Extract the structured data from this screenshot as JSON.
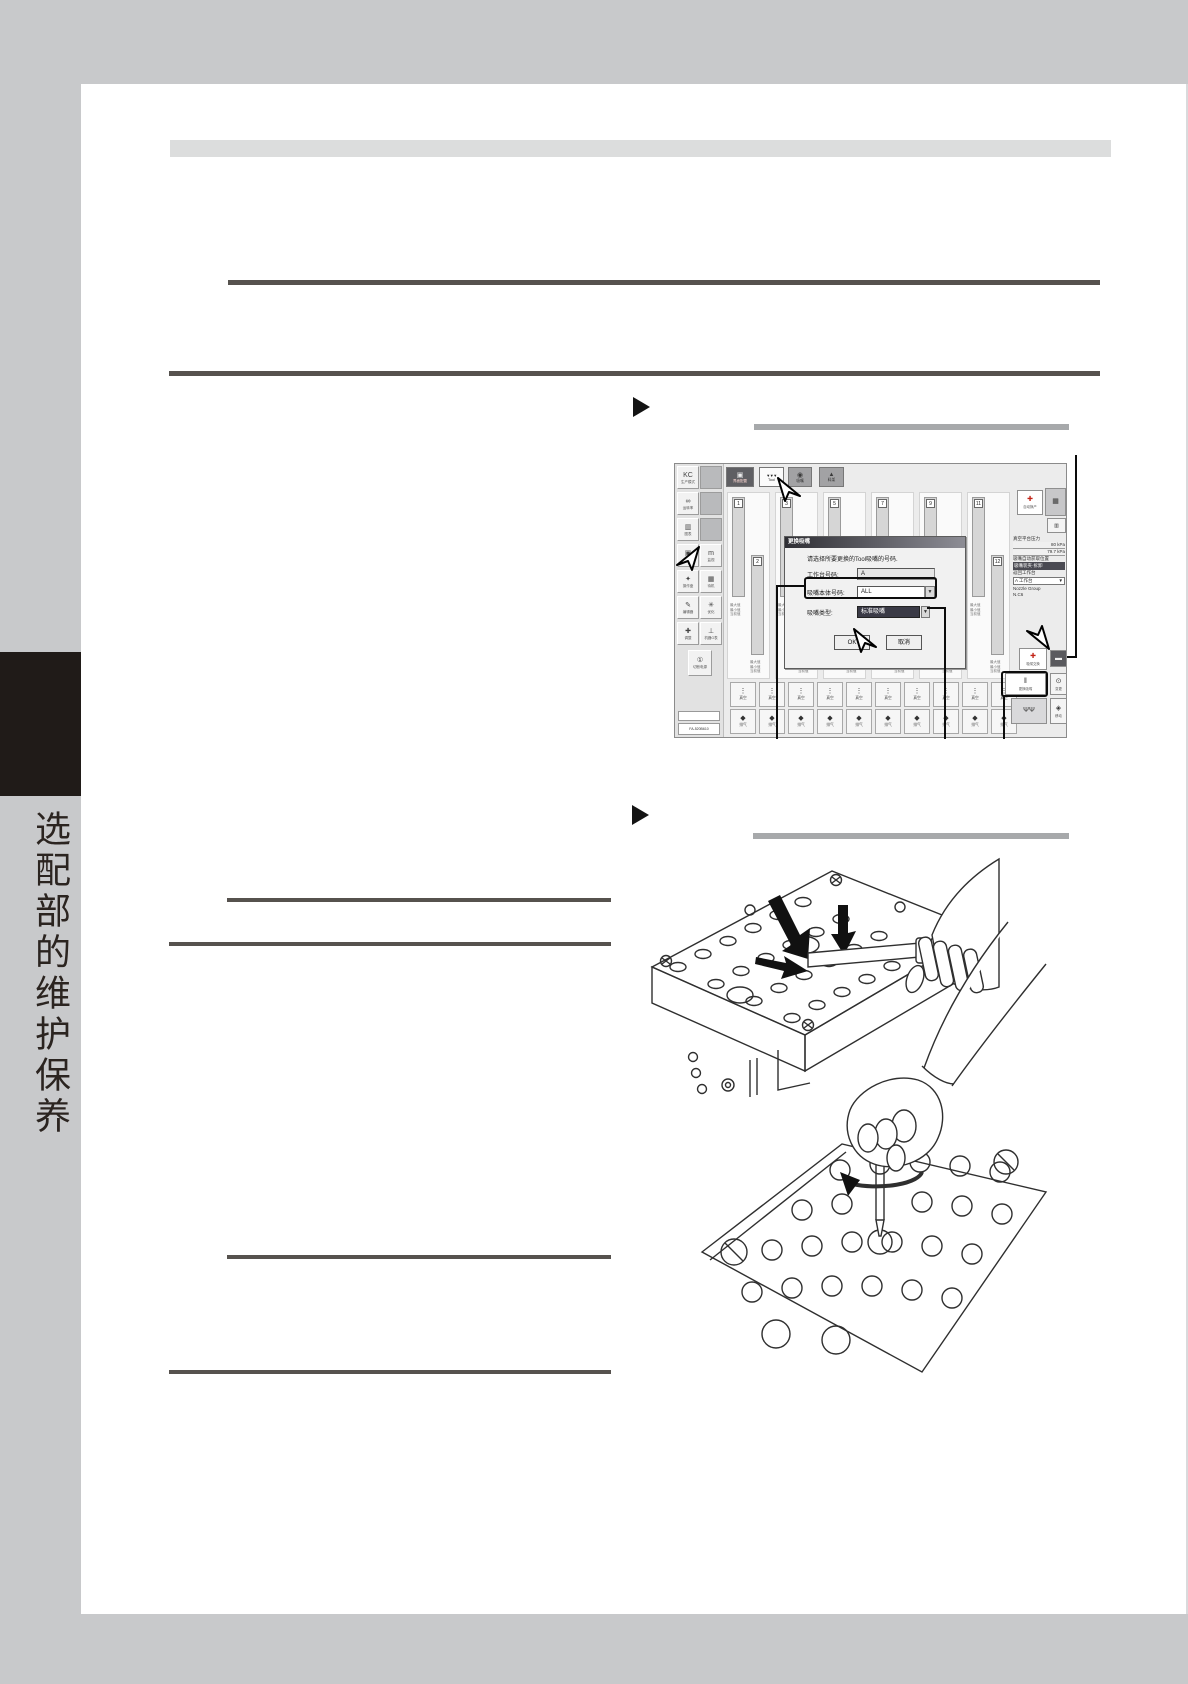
{
  "colors": {
    "canvas": "#c8c9cb",
    "rule": "#56524e",
    "section_bar": "#a7a9ab",
    "tab": "#201b18",
    "header_band": "#dcdddd"
  },
  "sidebar": {
    "tab_label": "选配部的维护保养"
  },
  "screenshot": {
    "top_toolbar": [
      {
        "glyph": "▣",
        "label": "界面配置"
      },
      {
        "glyph": "▼▼▼",
        "label": "Tool"
      },
      {
        "glyph": "◉",
        "label": "吸嘴"
      },
      {
        "glyph": "▲",
        "label": "料架"
      }
    ],
    "left_col1": [
      {
        "g": "ΚϹ",
        "label": "生产模式"
      },
      {
        "g": "∞",
        "label": "运转率"
      },
      {
        "g": "▥",
        "label": "图表"
      },
      {
        "g": "▣",
        "label": "屏幕"
      },
      {
        "g": "✦",
        "label": "操作盘"
      },
      {
        "g": "✎",
        "label": "编辑器"
      },
      {
        "g": "✚",
        "label": "调整"
      }
    ],
    "left_col2": [
      {
        "g": "m",
        "label": "监视"
      },
      {
        "g": "▦",
        "label": "待机"
      },
      {
        "g": "✳",
        "label": "优化"
      },
      {
        "g": "⊥",
        "label": "机器G表"
      }
    ],
    "power": {
      "g": "①",
      "label": "切断电源"
    },
    "status": {
      "line1": "",
      "line2": "FA-520B610"
    },
    "lanes": {
      "list": [
        {
          "back": "1",
          "front": "2"
        },
        {
          "back": "3",
          "front": "4"
        },
        {
          "back": "5",
          "front": "6"
        },
        {
          "back": "7",
          "front": "8"
        },
        {
          "back": "9",
          "front": "10"
        },
        {
          "back": "11",
          "front": "12"
        }
      ],
      "info": [
        "最大值",
        "最小值",
        "当前值"
      ]
    },
    "dialog": {
      "title": "更换吸嘴",
      "message": "请选择所要更换的Tool吸嘴的号码.",
      "field1_label": "工作台号码:",
      "field1_value": "A",
      "field2_label": "吸嘴本体号码:",
      "field2_value": "ALL",
      "field3_label": "吸嘴类型:",
      "field3_value": "标准吸嘴",
      "ok_label": "OK",
      "cancel_label": "取消"
    },
    "right_panel": {
      "btn_auto": {
        "g": "✚",
        "label": "自动换产"
      },
      "btn_cam": {
        "g": "▦",
        "label": ""
      },
      "btn_sub": {
        "g": "▥",
        "label": ""
      },
      "info_title": "真空平台压力",
      "info_value1": "80 kPa",
      "info_value2": "79.7 kPa",
      "info_label2": "吸嘴自动获取位置",
      "info_highlight": "吸嘴装夹·拆卸",
      "combo_label": "返回工作台",
      "combo_value": "A 工作台",
      "combo_arrow": "▼",
      "group_label": "Nozzle Group",
      "group_value": "N.C6",
      "grid": [
        {
          "g": "✚",
          "label": "吸嘴交换",
          "red": true
        },
        {
          "g": "▬",
          "label": ""
        },
        {
          "g": "‖",
          "label": "更换吸嘴"
        },
        {
          "g": "⊙",
          "label": "变更"
        },
        {
          "g": "ΨΨ",
          "label": ""
        },
        {
          "g": "◈",
          "label": "移动"
        }
      ]
    },
    "bottom_cells": {
      "slots": [
        "",
        "",
        "",
        "",
        "",
        "",
        "",
        "",
        "",
        ""
      ],
      "row1_glyph": "⋮",
      "row1_label": "真空",
      "row2_glyph": "◆",
      "row2_label": "排气"
    }
  }
}
